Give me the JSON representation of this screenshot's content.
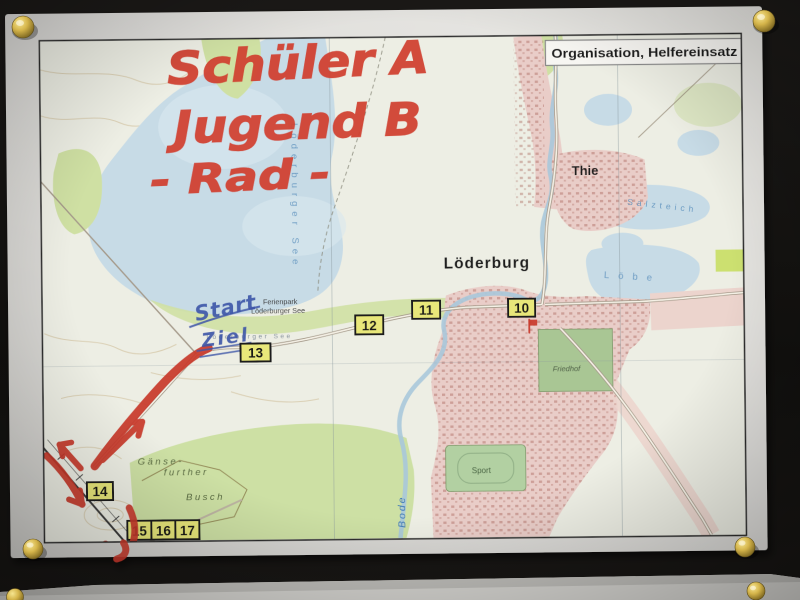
{
  "photo": {
    "board_color": "#131110",
    "paper_color": "#e0dfdb",
    "pin_style": "brass-thumbtack"
  },
  "legend": {
    "title": "Organisation, Helfereinsatz"
  },
  "handwriting": {
    "red_line1": "Schüler A",
    "red_line2": "Jugend B",
    "red_line3": "- Rad -",
    "blue_start": "Start",
    "blue_ziel": "Ziel",
    "red_color": "#c9392b",
    "blue_color": "#3d56a8"
  },
  "places": {
    "town": "Löderburg",
    "village": "Thie",
    "ferienpark": "Ferienpark",
    "lake": "Löderburger See",
    "cemetery": "Friedhof",
    "sports": "Sport",
    "river": "Bode",
    "salt_pond": "Salzteich",
    "east_lake": "Löbe",
    "forest_line1": "Gänse-",
    "forest_line2": "further",
    "forest_line3": "Busch"
  },
  "waypoints": [
    "10",
    "11",
    "12",
    "13",
    "14",
    "15",
    "16",
    "17"
  ],
  "map_colors": {
    "water": "#c7dbe6",
    "field_green": "#cfe0a3",
    "urban_pink": "#e9cdc8",
    "waypoint_yellow": "#e8e77a",
    "route_red": "#c9392b"
  }
}
